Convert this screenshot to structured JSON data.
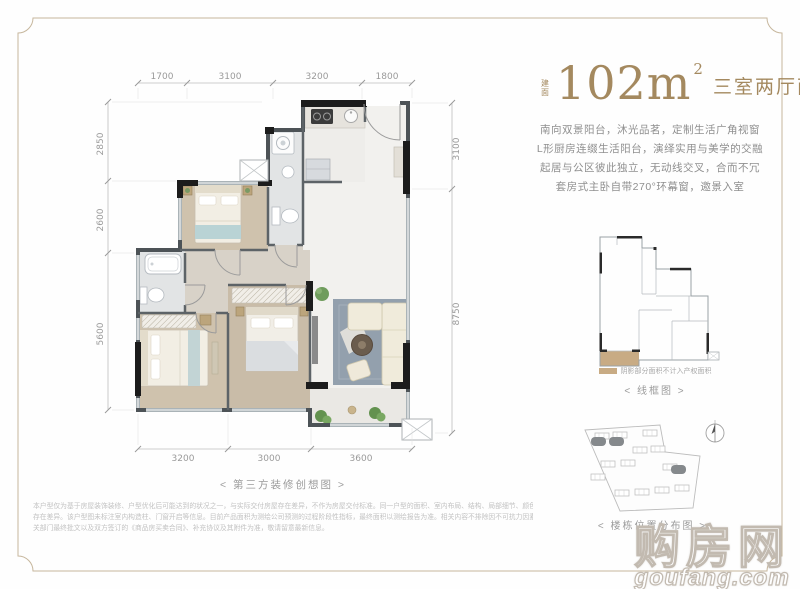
{
  "header": {
    "area_prefix": "建面",
    "area_value": "102m",
    "area_sup": "2",
    "layout_label": "三室两厅两卫"
  },
  "description": {
    "lines": [
      "南向双景阳台，沐光品茗，定制生活广角视窗",
      "L形厨房连缀生活阳台，演绎实用与美学的交融",
      "起居与公区彼此独立，无动线交叉，合而不冗",
      "套房式主卧自带270°环幕窗，邀景入室"
    ]
  },
  "floor_plan": {
    "caption": "< 第三方装修创想图 >",
    "dims_top": [
      "1700",
      "3100",
      "3200",
      "1800"
    ],
    "dims_left": [
      "2850",
      "2600",
      "5600"
    ],
    "dims_right": [
      "3100",
      "8750"
    ],
    "dims_bottom": [
      "3200",
      "3000",
      "3600"
    ]
  },
  "wireframe": {
    "legend_label": "阴影部分面积不计入产权面积",
    "caption": "< 线框图 >",
    "shade_color": "#c8ab84"
  },
  "site_map": {
    "caption": "< 楼栋位置分布图 >"
  },
  "disclaimer": {
    "lines": [
      "本户型仅为基于房屋装饰装修、户型优化后可能达到的状况之一，与实际交付房屋存在差异，不作为房屋交付标准。同一户型的面积、室内布局、结构、局部细节、颜色等因楼栋、楼层、单元、房号的原因可能",
      "存在差异。该户型图未标注室内构造柱、门窗开启等信息。目前产品面积为测绘公司预测的过程阶段性指标，最终面积以测绘报告为准。相关内容不排除因不可抗力因素并经本公司审慎决定进行调整，实际交付以政府相",
      "关部门最终批文以及双方签订的《商品房买卖合同》、补充协议及其附件为准，敬请留意最新信息。"
    ]
  },
  "watermark": {
    "brand": "购房网",
    "domain": "goufang.com"
  },
  "colors": {
    "accent": "#a4895f",
    "frame": "#c6b69c",
    "wall_dark": "#1c1c1c",
    "dim_text": "#9a9a9a",
    "shade": "#c8ab84"
  }
}
